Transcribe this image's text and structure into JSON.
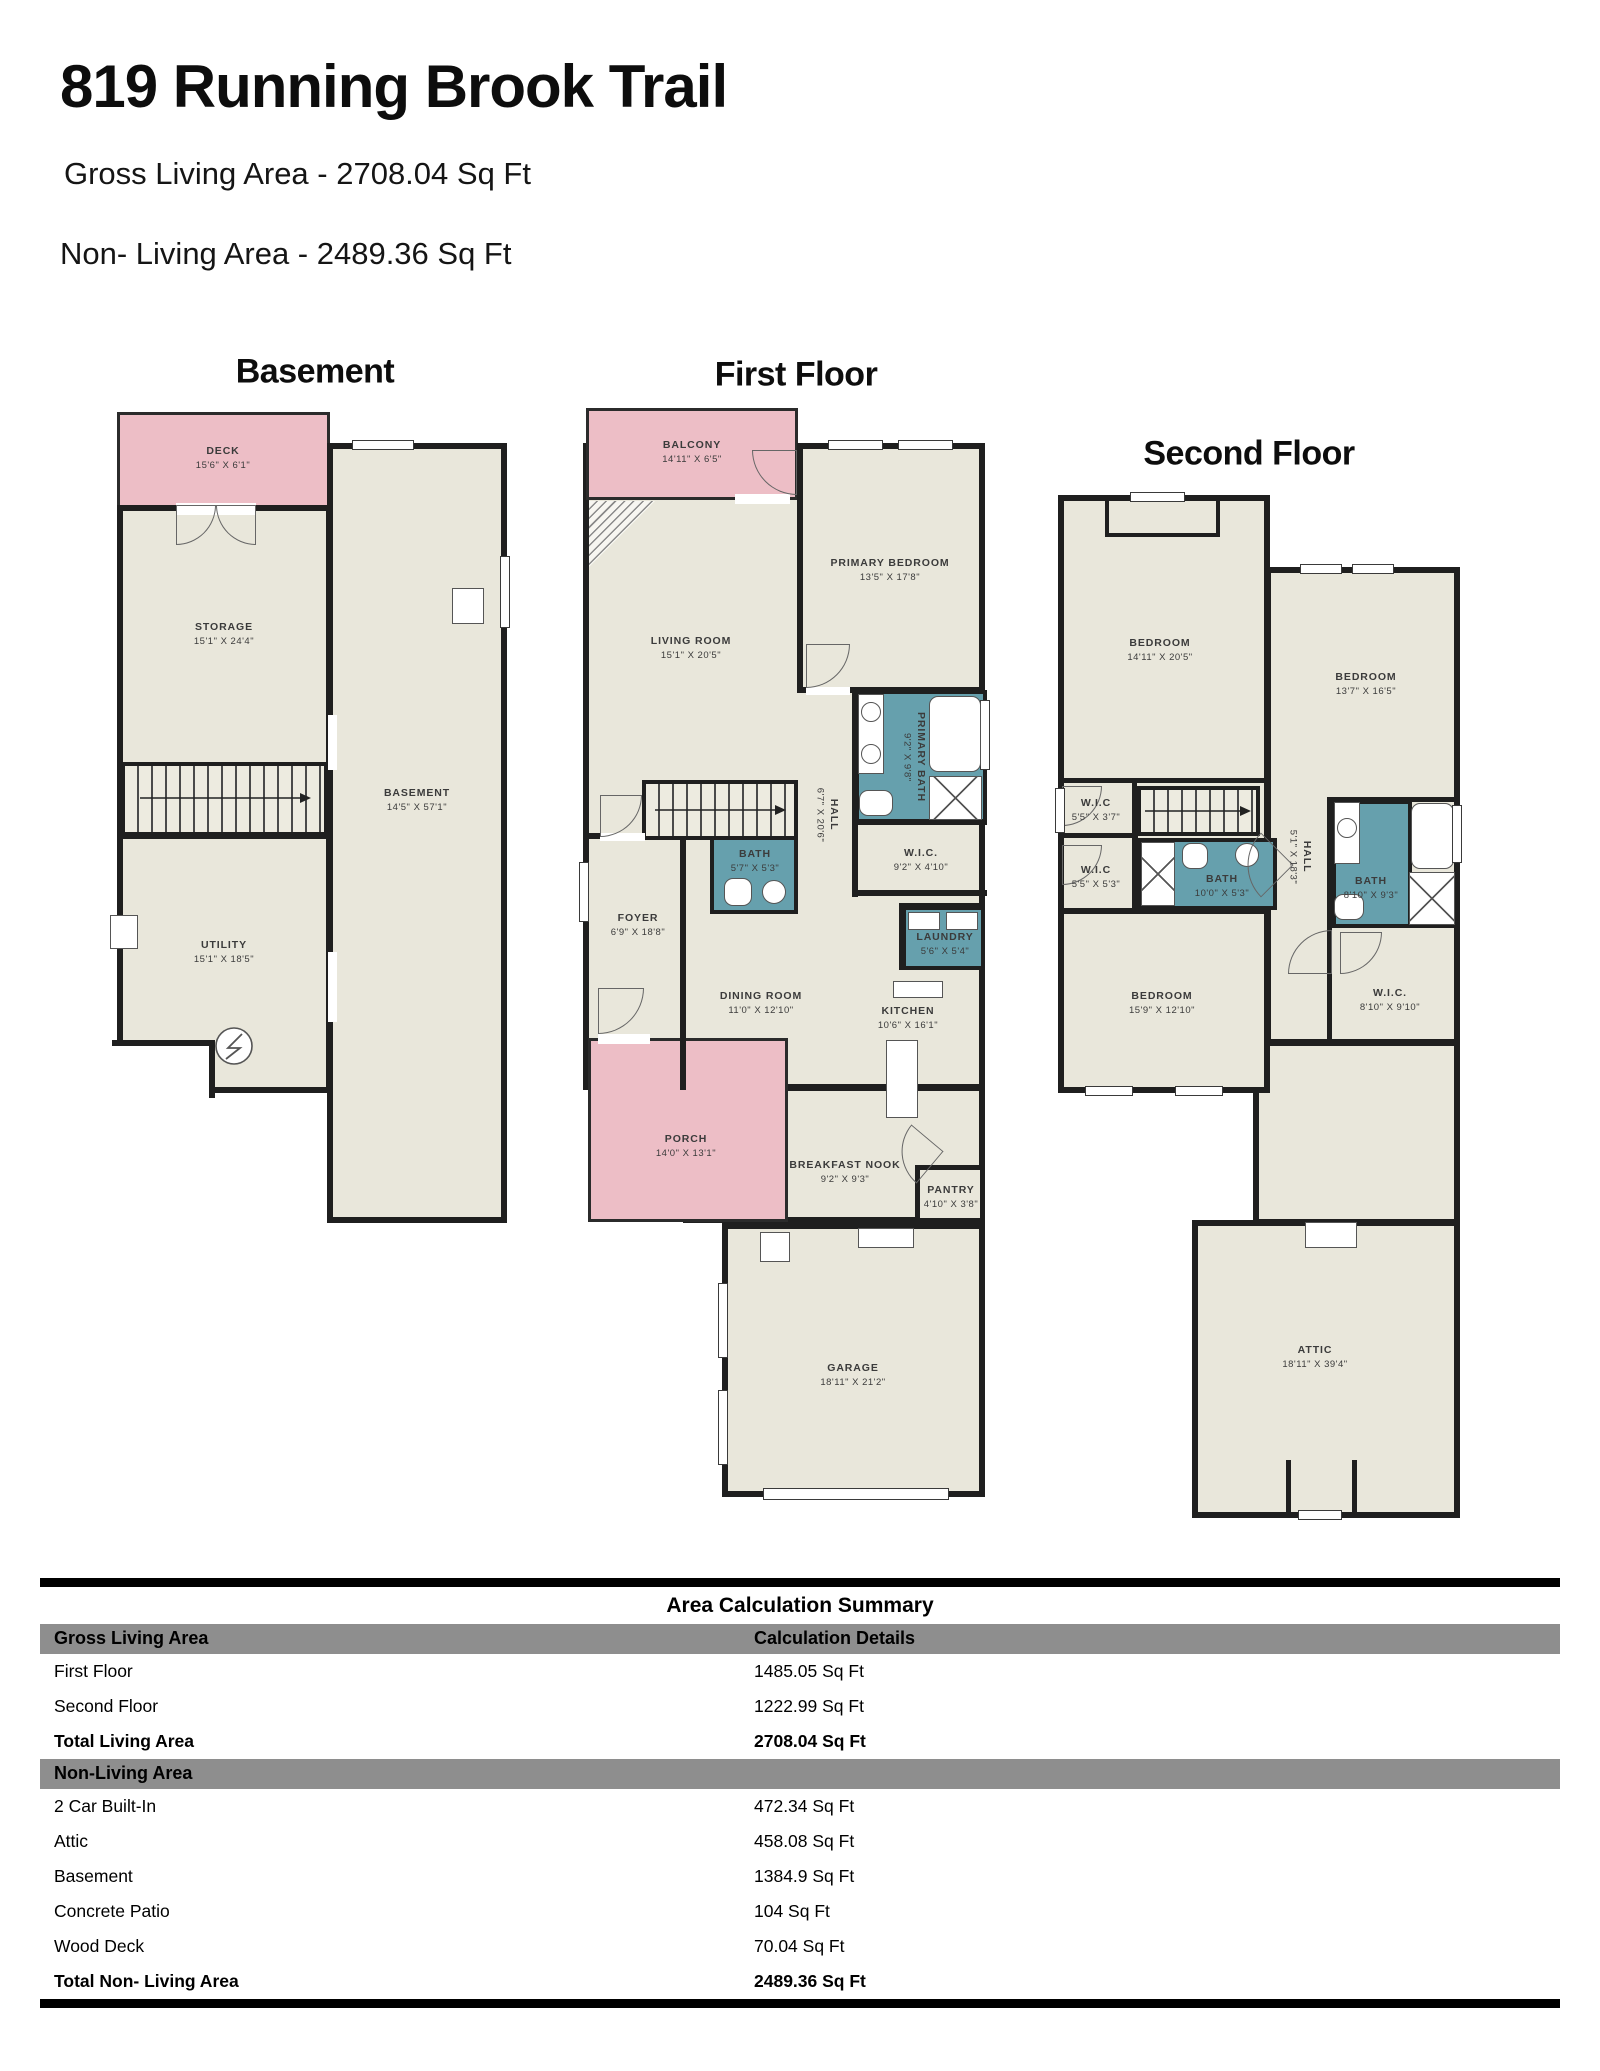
{
  "header": {
    "title": "819 Running Brook Trail",
    "gross_line": "Gross Living Area - 2708.04 Sq Ft",
    "non_living_line": "Non- Living Area - 2489.36 Sq Ft"
  },
  "palette": {
    "floor_beige": "#e9e7db",
    "outdoor_pink": "#edbec6",
    "bath_teal": "#66a0ad",
    "wall_black": "#1f1f1f",
    "table_header_gray": "#8e8e8e"
  },
  "floors": {
    "basement": {
      "title": "Basement",
      "rooms": {
        "deck": {
          "name": "DECK",
          "dims": "15'6\" X 6'1\""
        },
        "storage": {
          "name": "STORAGE",
          "dims": "15'1\" X 24'4\""
        },
        "basement": {
          "name": "BASEMENT",
          "dims": "14'5\" X 57'1\""
        },
        "utility": {
          "name": "UTILITY",
          "dims": "15'1\" X 18'5\""
        }
      }
    },
    "first": {
      "title": "First Floor",
      "rooms": {
        "balcony": {
          "name": "BALCONY",
          "dims": "14'11\" X 6'5\""
        },
        "living": {
          "name": "LIVING ROOM",
          "dims": "15'1\" X 20'5\""
        },
        "primary_bedroom": {
          "name": "PRIMARY BEDROOM",
          "dims": "13'5\" X 17'8\""
        },
        "primary_bath": {
          "name": "PRIMARY BATH",
          "dims": "9'2\" X 9'8\""
        },
        "hall": {
          "name": "HALL",
          "dims": "6'7\" X 20'6\""
        },
        "wic": {
          "name": "W.I.C.",
          "dims": "9'2\" X 4'10\""
        },
        "bath": {
          "name": "BATH",
          "dims": "5'7\" X 5'3\""
        },
        "foyer": {
          "name": "FOYER",
          "dims": "6'9\" X 18'8\""
        },
        "laundry": {
          "name": "LAUNDRY",
          "dims": "5'6\" X 5'4\""
        },
        "dining": {
          "name": "DINING ROOM",
          "dims": "11'0\" X 12'10\""
        },
        "kitchen": {
          "name": "KITCHEN",
          "dims": "10'6\" X 16'1\""
        },
        "porch": {
          "name": "PORCH",
          "dims": "14'0\" X 13'1\""
        },
        "nook": {
          "name": "BREAKFAST NOOK",
          "dims": "9'2\" X 9'3\""
        },
        "pantry": {
          "name": "PANTRY",
          "dims": "4'10\" X 3'8\""
        },
        "garage": {
          "name": "GARAGE",
          "dims": "18'11\" X 21'2\""
        }
      }
    },
    "second": {
      "title": "Second Floor",
      "rooms": {
        "bedroom1": {
          "name": "BEDROOM",
          "dims": "14'11\" X 20'5\""
        },
        "bedroom2": {
          "name": "BEDROOM",
          "dims": "13'7\" X 16'5\""
        },
        "wic_a": {
          "name": "W.I.C",
          "dims": "5'5\" X 3'7\""
        },
        "wic_b": {
          "name": "W.I.C",
          "dims": "5'5\" X 5'3\""
        },
        "bath_a": {
          "name": "BATH",
          "dims": "10'0\" X 5'3\""
        },
        "hall": {
          "name": "HALL",
          "dims": "5'1\" X 18'3\""
        },
        "bath_b": {
          "name": "BATH",
          "dims": "8'10\" X 9'3\""
        },
        "wic_c": {
          "name": "W.I.C.",
          "dims": "8'10\" X 9'10\""
        },
        "bedroom3": {
          "name": "BEDROOM",
          "dims": "15'9\" X 12'10\""
        },
        "attic": {
          "name": "ATTIC",
          "dims": "18'11\" X 39'4\""
        }
      }
    }
  },
  "summary": {
    "title": "Area Calculation Summary",
    "col1_header": "Gross Living Area",
    "col2_header": "Calculation Details",
    "living_rows": [
      [
        "First Floor",
        "1485.05 Sq Ft"
      ],
      [
        "Second Floor",
        "1222.99 Sq Ft"
      ]
    ],
    "living_total": [
      "Total Living Area",
      "2708.04 Sq Ft"
    ],
    "non_living_header": "Non-Living Area",
    "non_living_rows": [
      [
        "2 Car Built-In",
        "472.34 Sq Ft"
      ],
      [
        "Attic",
        "458.08 Sq Ft"
      ],
      [
        "Basement",
        "1384.9 Sq Ft"
      ],
      [
        "Concrete Patio",
        "104 Sq Ft"
      ],
      [
        "Wood Deck",
        "70.04 Sq Ft"
      ]
    ],
    "non_living_total": [
      "Total Non- Living Area",
      "2489.36 Sq Ft"
    ]
  }
}
